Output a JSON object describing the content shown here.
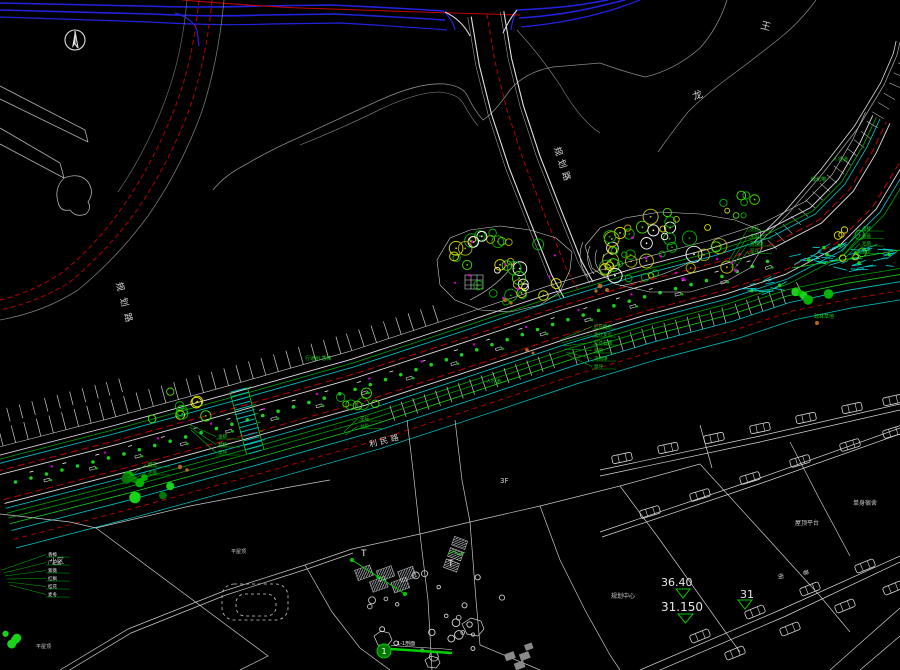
{
  "colors": {
    "background": "#000000",
    "blue_utility": "#2222e0",
    "red_line": "#c00000",
    "white_line": "#e0e0e0",
    "gray_line": "#8a8a8a",
    "cyan_line": "#00cccc",
    "green_line": "#00a800",
    "bright_green": "#19d219",
    "yellow_tree": "#c8c800",
    "magenta_dot": "#d000d0",
    "rock_brown": "#b06820"
  },
  "road_names": {
    "planned_top": "规划路",
    "planned_left": "规划路",
    "south_road": "利民路"
  },
  "map_chars": {
    "char1": "王",
    "char2": "龙"
  },
  "spots": [
    {
      "v": "36.40"
    },
    {
      "v": "31.150"
    },
    {
      "v": "31"
    }
  ],
  "section": {
    "no": "1",
    "label": "1-1剖面"
  },
  "floor_label": "3F",
  "site_labels": [
    {
      "t": "规划中心",
      "x": 611,
      "y": 598,
      "s": 6,
      "c": "#cfcfcf",
      "r": 0
    },
    {
      "t": "单身宿舍",
      "x": 853,
      "y": 505,
      "s": 6,
      "c": "#cfcfcf",
      "r": 0
    },
    {
      "t": "屋顶平台",
      "x": 795,
      "y": 525,
      "s": 6,
      "c": "#cfcfcf",
      "r": 0
    },
    {
      "t": "小区",
      "x": 50,
      "y": 563,
      "s": 7,
      "c": "#cfcfcf",
      "r": 0
    },
    {
      "t": "平屋顶",
      "x": 231,
      "y": 553,
      "s": 5,
      "c": "#cfcfcf",
      "r": 0
    },
    {
      "t": "平屋顶",
      "x": 36,
      "y": 648,
      "s": 5,
      "c": "#cfcfcf",
      "r": 0
    },
    {
      "t": "T",
      "x": 361,
      "y": 556,
      "s": 9,
      "c": "#e8e8e8",
      "r": 0
    },
    {
      "t": "T",
      "x": 448,
      "y": 566,
      "s": 9,
      "c": "#e8e8e8",
      "r": 0
    },
    {
      "t": "人行道",
      "x": 833,
      "y": 161,
      "s": 5,
      "c": "#19d219",
      "r": 0
    },
    {
      "t": "绿化带",
      "x": 811,
      "y": 181,
      "s": 5,
      "c": "#19d219",
      "r": 0
    },
    {
      "t": "人行道",
      "x": 486,
      "y": 383,
      "s": 5,
      "c": "#19d219",
      "r": 0
    },
    {
      "t": "行道树 香樟",
      "x": 305,
      "y": 360,
      "s": 5,
      "c": "#19d219",
      "r": 0
    },
    {
      "t": "疏林草地",
      "x": 814,
      "y": 318,
      "s": 5,
      "c": "#19d219",
      "r": 0
    },
    {
      "t": "街",
      "x": 778,
      "y": 574,
      "s": 6,
      "c": "#cfcfcf",
      "r": 75
    },
    {
      "t": "巷",
      "x": 803,
      "y": 570,
      "s": 6,
      "c": "#cfcfcf",
      "r": 75
    }
  ],
  "plant_stacks": [
    {
      "x": 594,
      "y": 328,
      "dy": 8,
      "s": 4.5,
      "c": "#19d219",
      "ax": 560,
      "ay": 340,
      "rows": [
        "红花檵木",
        "金叶女贞",
        "红叶石楠",
        "毛鹃",
        "海桐球",
        "草坪"
      ]
    },
    {
      "x": 48,
      "y": 556,
      "dy": 8,
      "s": 4.5,
      "c": "#e8e8e8",
      "ax": 2,
      "ay": 570,
      "rows": [
        "香樟",
        "广玉兰",
        "紫薇",
        "红枫",
        "桂花",
        "麦冬"
      ]
    },
    {
      "x": 218,
      "y": 438,
      "dy": 8,
      "s": 4.5,
      "c": "#19d219",
      "ax": 188,
      "ay": 424,
      "rows": [
        "垂柳",
        "碧桃",
        "草坪"
      ]
    },
    {
      "x": 148,
      "y": 466,
      "dy": 8,
      "s": 4.5,
      "c": "#19d219",
      "ax": 128,
      "ay": 478,
      "rows": [
        "樱花",
        "毛鹃"
      ]
    },
    {
      "x": 750,
      "y": 230,
      "dy": 7.5,
      "s": 4.5,
      "c": "#19d219",
      "ax": 728,
      "ay": 262,
      "rows": [
        "水杉",
        "栾树",
        "黄杨球",
        "草坪"
      ]
    },
    {
      "x": 862,
      "y": 230,
      "dy": 7.5,
      "s": 4.5,
      "c": "#19d219",
      "ax": 842,
      "ay": 252,
      "rows": [
        "垂柳",
        "紫薇",
        "毛鹃",
        "麦冬"
      ]
    },
    {
      "x": 360,
      "y": 420,
      "dy": 7.5,
      "s": 4.5,
      "c": "#19d219",
      "ax": 344,
      "ay": 432,
      "rows": [
        "花坛",
        "台阶"
      ]
    }
  ]
}
